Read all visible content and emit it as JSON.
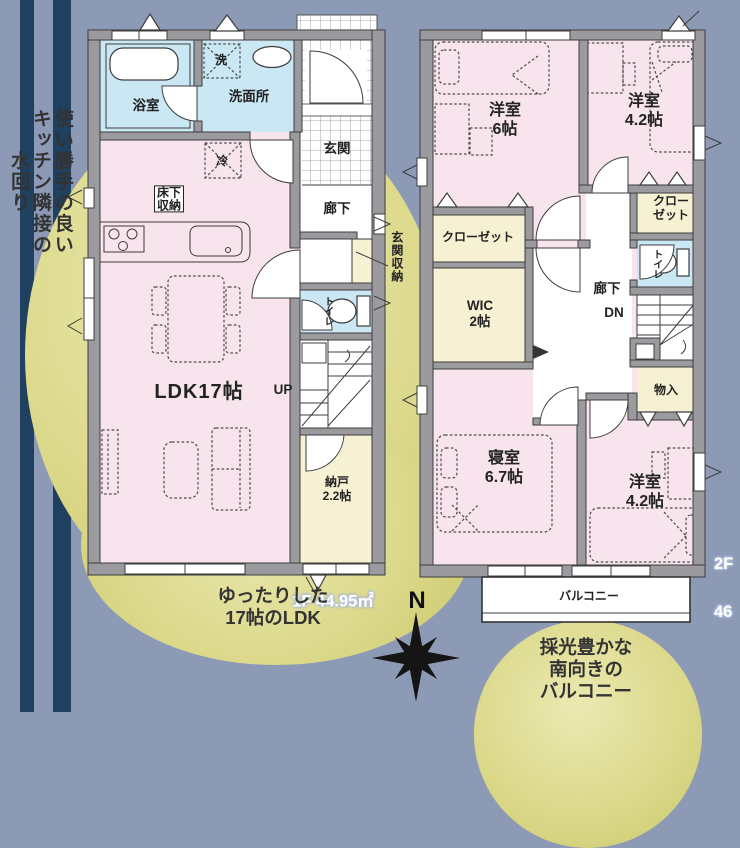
{
  "page": {
    "background": "#8c9ab6",
    "stripe_color": "#20405f",
    "highlight_circle_color": "#d6d37e",
    "room_pink": "#f7e4ec",
    "room_blue": "#cae7f4",
    "room_yellow": "#f6f1d3",
    "wall_gray": "#9b9b9f"
  },
  "annotations": {
    "kitchen_note": "使い勝手の良い\nキッチン隣接の\n水回り",
    "ldk_note": "ゆったりした\n17帖のLDK",
    "balcony_note": "採光豊かな\n南向きの\nバルコニー"
  },
  "compass": {
    "north": "N"
  },
  "floor1": {
    "area": "1F 44.95㎡",
    "labels": {
      "bathroom": "浴室",
      "laundry": "洗",
      "washroom": "洗面所",
      "fridge": "冷",
      "underfloor_storage": "床下\n収納",
      "entrance": "玄関",
      "hallway": "廊下",
      "entrance_storage": "玄関収納",
      "toilet": "トイレ",
      "stairs_up": "UP",
      "ldk": "LDK17帖",
      "storeroom": "納戸\n2.2帖"
    }
  },
  "floor2": {
    "floor_tag": "2F",
    "area_partial": "46",
    "labels": {
      "bedroom6": "洋室\n6帖",
      "bedroom42_top": "洋室\n4.2帖",
      "closet_left": "クローゼット",
      "closet_right": "クロー\nゼット",
      "wic": "WIC\n2帖",
      "toilet": "トイレ",
      "hallway": "廊下",
      "stairs_down": "DN",
      "storage": "物入",
      "master_bedroom": "寝室\n6.7帖",
      "bedroom42_bottom": "洋室\n4.2帖",
      "balcony": "バルコニー"
    }
  }
}
